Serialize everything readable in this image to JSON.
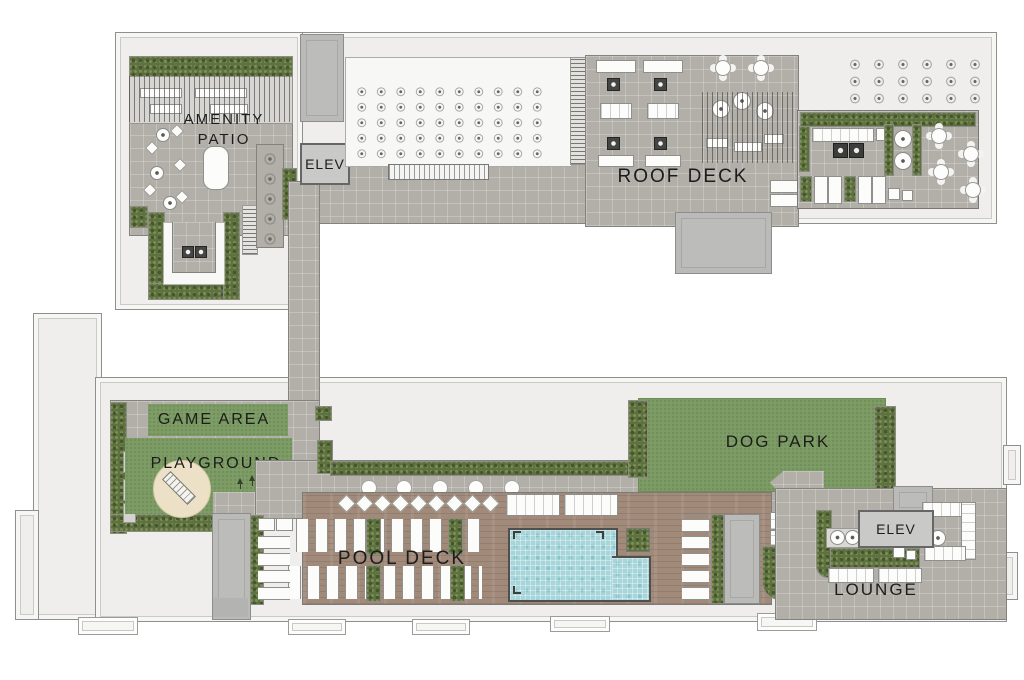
{
  "areas": [
    {
      "id": "amenity-patio",
      "label": "AMENITY PATIO",
      "label_lines": [
        "AMENITY",
        "PATIO"
      ]
    },
    {
      "id": "elev-upper",
      "label": "ELEV"
    },
    {
      "id": "roof-deck",
      "label": "ROOF DECK"
    },
    {
      "id": "game-area",
      "label": "GAME AREA"
    },
    {
      "id": "playground",
      "label": "PLAYGROUND"
    },
    {
      "id": "dog-park",
      "label": "DOG PARK"
    },
    {
      "id": "pool-deck",
      "label": "POOL DECK"
    },
    {
      "id": "elev-lower",
      "label": "ELEV"
    },
    {
      "id": "lounge",
      "label": "LOUNGE"
    }
  ],
  "colors": {
    "paving": "#b2afa9",
    "lawn": "#7f9e66",
    "hedge": "#5e7141",
    "wood_deck": "#a18a7a",
    "pool_water": "#a7d6da",
    "sand_play_surface": "#ece1c6",
    "roof_white": "#f7f7f5",
    "building_outline": "#efeeec",
    "structure_gray": "#bcbcba",
    "label_text": "#1c1c1c"
  }
}
